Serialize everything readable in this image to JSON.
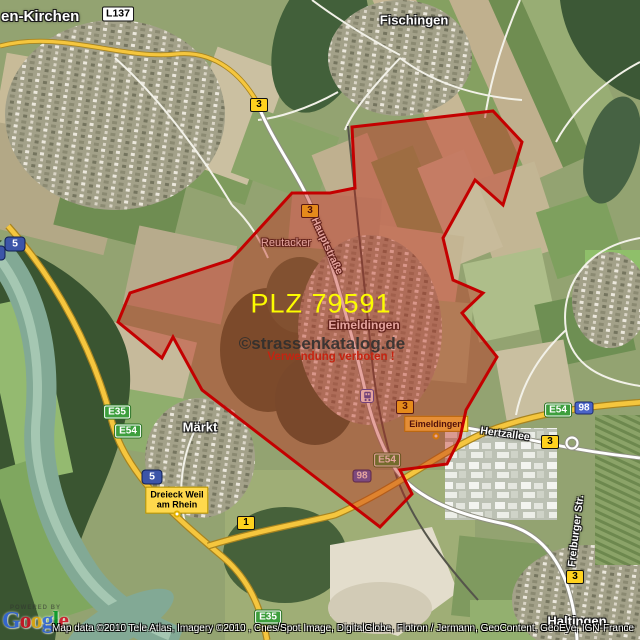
{
  "map": {
    "plz_label": "PLZ 79591",
    "watermark": "©strassenkatalog.de",
    "watermark_warning": "Verwendung verboten !",
    "overlay_outline_color": "#c40000",
    "overlay_fill_color": "rgba(193,39,24,0.42)",
    "overlay_polygon_points": "352,127 493,111 522,142 503,205 475,180 443,238 453,280 483,293 462,313 497,357 466,410 460,438 447,464 400,470 412,494 380,527 202,390 173,337 162,358 118,322 130,293 230,260 240,250 292,193 330,193 355,188"
  },
  "places": {
    "efringen_kirchen": "en-Kirchen",
    "fischingen": "Fischingen",
    "eimeldingen": "Eimeldingen",
    "reutacker": "Reutacker",
    "maerkt": "Märkt",
    "haltingen": "Haltingen"
  },
  "streets": {
    "hauptstrasse": "Hauptstraße",
    "hertzallee": "Hertzallee",
    "freiburger_str": "Freiburger Str."
  },
  "road_badges": {
    "l137": "L137",
    "b3": "3",
    "b1": "1",
    "a5": "5",
    "a98": "98",
    "e35": "E35",
    "e54": "E54"
  },
  "info_boxes": {
    "dreieck_line1": "Dreieck Weil",
    "dreieck_line2": "am Rhein",
    "eimeldingen_exit": "Eimeldingen"
  },
  "badge_colors": {
    "bundesstrasse_bg": "#ffd21e",
    "autobahn_bg": "#3c55a8",
    "eroute_bg": "#3d9e3d",
    "landesstrasse_bg": "#ffffff",
    "motorway_road": "#f5c63e"
  },
  "attribution": {
    "powered_by": "POWERED BY",
    "logo_letters": [
      {
        "ch": "G",
        "color": "#3369e8"
      },
      {
        "ch": "o",
        "color": "#d50f25"
      },
      {
        "ch": "o",
        "color": "#eeb211"
      },
      {
        "ch": "g",
        "color": "#3369e8"
      },
      {
        "ch": "l",
        "color": "#009925"
      },
      {
        "ch": "e",
        "color": "#d50f25"
      }
    ],
    "copyright": "Map data ©2010 Tele Atlas, Imagery ©2010 , Cnes/Spot Image, DigitalGlobe, Flotron / Jermann, GeoContent, GeoEye, IGN-France"
  }
}
